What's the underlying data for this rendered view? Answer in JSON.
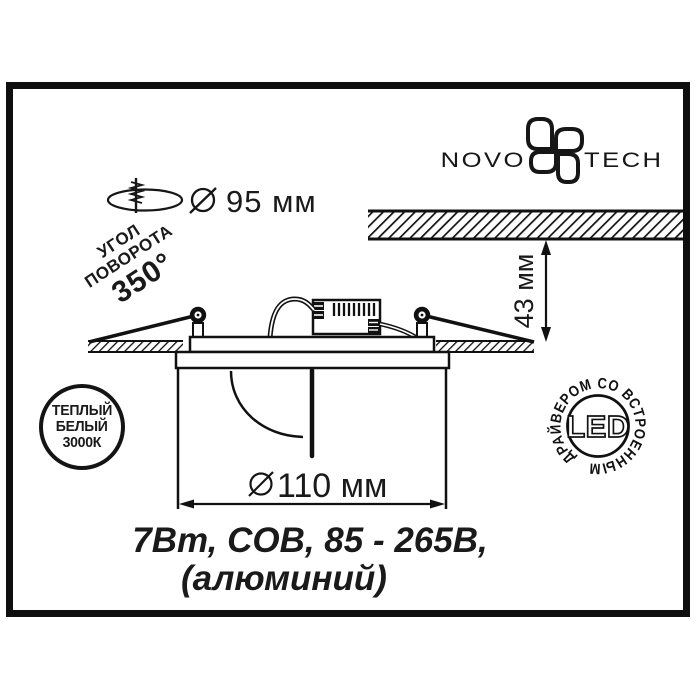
{
  "brand": {
    "name_left": "NOVO",
    "name_right": "TECH"
  },
  "specs": {
    "cutout_diameter_value": "95 мм",
    "rotation": {
      "line1": "УГОЛ",
      "line2": "ПОВОРОТА",
      "line3": "350°"
    },
    "recess_height_value": "43 мм",
    "body_diameter_value": "110 мм",
    "power_line": "7Вт, COB, 85 - 265В,",
    "material_line": "(алюминий)"
  },
  "badges": {
    "color_temp": {
      "line1": "ТЕПЛЫЙ",
      "line2": "БЕЛЫЙ",
      "line3": "3000К"
    },
    "led": {
      "center": "LED",
      "ring": "ДРАЙВЕРОМ СО ВСТРОЕННЫМ"
    }
  },
  "colors": {
    "ink": "#111111",
    "background": "#ffffff"
  }
}
